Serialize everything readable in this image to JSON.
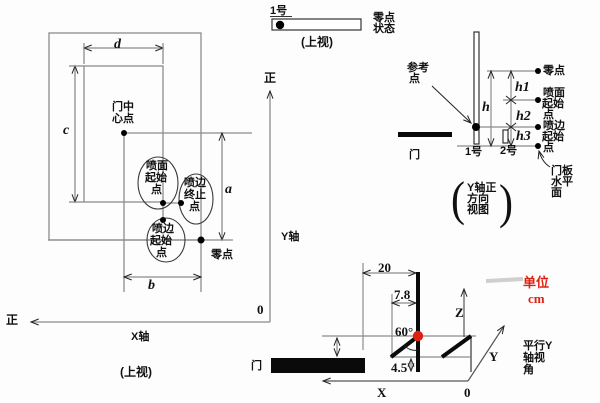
{
  "colors": {
    "line": "#8c8c8c",
    "ink": "#111111",
    "accent_red": "#de2013"
  },
  "left_view": {
    "dim_d": "d",
    "dim_c": "c",
    "dim_a": "a",
    "dim_b": "b",
    "door_center": [
      "门中",
      "心点"
    ],
    "spray_face_start": [
      "喷面",
      "起始",
      "点"
    ],
    "spray_edge_end": [
      "喷边",
      "终止",
      "点"
    ],
    "spray_edge_start": [
      "喷边",
      "起始",
      "点"
    ],
    "zero_point": "零点",
    "positive_up": "正",
    "positive_left": "正",
    "y_axis": "Y轴",
    "x_axis": "X轴",
    "origin": "0",
    "caption": "(上视)"
  },
  "gun_top_view": {
    "gun1": "1号",
    "zero_state": [
      "零点",
      "状态"
    ],
    "caption": "(上视)"
  },
  "side_view": {
    "reference_point": [
      "参考",
      "点"
    ],
    "zero_point": "零点",
    "spray_face_start": [
      "喷面",
      "起始",
      "点"
    ],
    "spray_edge_start": [
      "喷边",
      "起始",
      "点"
    ],
    "door_plane": [
      "门板",
      "水平",
      "面"
    ],
    "door": "门",
    "gun1": "1号",
    "gun2": "2号",
    "dim_h": "h",
    "dim_h1": "h1",
    "dim_h2": "h2",
    "dim_h3": "h3",
    "caption_lines": [
      "Y轴正",
      "方向",
      "视图"
    ],
    "paren_open": "(",
    "paren_close": ")"
  },
  "perspective_view": {
    "dim_20": "20",
    "dim_7_8": "7.8",
    "dim_4_5": "4.5",
    "angle": "60°",
    "axis_x": "X",
    "axis_y": "Y",
    "axis_z": "Z",
    "origin": "0",
    "door": "门",
    "view_label": [
      "平行Y",
      "轴视",
      "角"
    ],
    "unit_label": "单位",
    "unit_value": "cm"
  }
}
